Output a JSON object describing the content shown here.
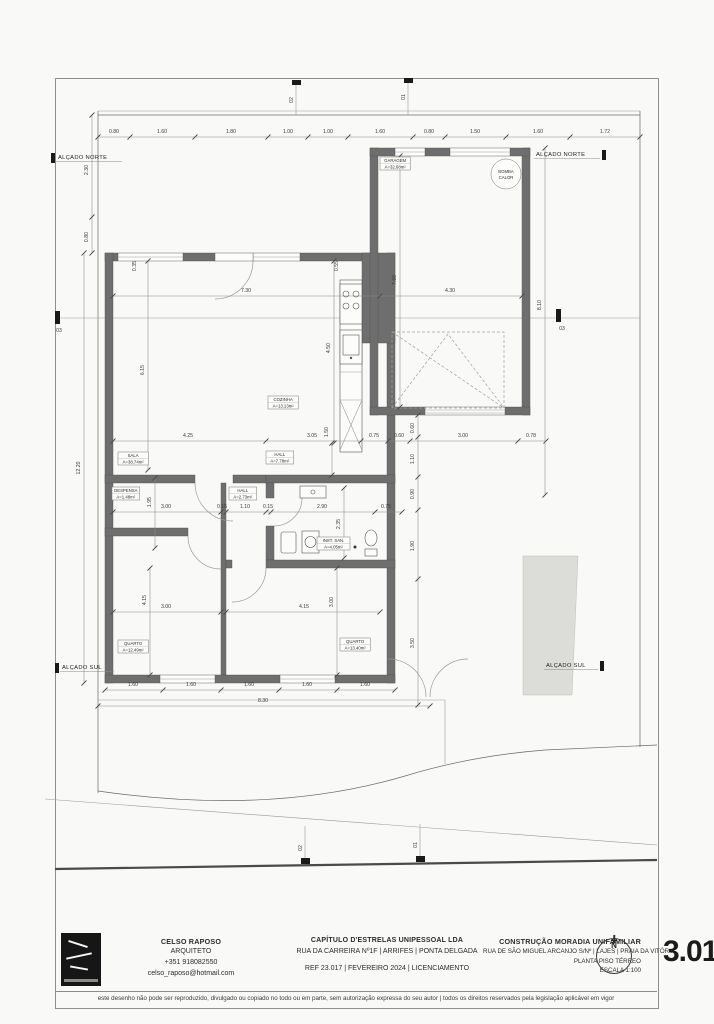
{
  "sheet": {
    "number": "3.01",
    "disclaimer": "este desenho não pode ser reproduzido, divulgado ou copiado no todo ou em parte, sem autorização expressa do seu autor | todos os direitos reservados pela legislação aplicável em vigor"
  },
  "title_block": {
    "architect": {
      "name": "CELSO RAPOSO",
      "role": "ARQUITETO",
      "phone": "+351 918082550",
      "email": "celso_raposo@hotmail.com"
    },
    "office": {
      "name": "CAPÍTULO D'ESTRELAS UNIPESSOAL LDA",
      "address": "RUA DA CARREIRA Nº1F | ARRIFES | PONTA DELGADA",
      "ref": "REF 23.017 | FEVEREIRO 2024 | LICENCIAMENTO"
    },
    "project": {
      "name": "CONSTRUÇÃO MORADIA UNIFAMILIAR",
      "address": "RUA DE SÃO MIGUEL ARCANJO S/Nº | LAJES | PRAIA DA VITÓRIA",
      "drawing": "PLANTA PISO TÉRREO",
      "scale": "ESCALA 1:100"
    },
    "north": "N"
  },
  "plan": {
    "room_labels": [
      {
        "name": "GARAGEM",
        "area": "A=32.68m²",
        "x": 380,
        "y": 157
      },
      {
        "name": "SALA",
        "area": "A=38.74m²",
        "x": 118,
        "y": 452
      },
      {
        "name": "COZINHA",
        "area": "A=13.13m²",
        "x": 268,
        "y": 396
      },
      {
        "name": "HALL",
        "area": "A=7.78m²",
        "x": 266,
        "y": 451
      },
      {
        "name": "HALL",
        "area": "A=2.73m²",
        "x": 229,
        "y": 487
      },
      {
        "name": "DESPENSA",
        "area": "A=1.48m²",
        "x": 112,
        "y": 487
      },
      {
        "name": "INST. SAN.",
        "area": "A=4.05m²",
        "x": 317,
        "y": 537
      },
      {
        "name": "QUARTO",
        "area": "A=12.49m²",
        "x": 118,
        "y": 640
      },
      {
        "name": "QUARTO",
        "area": "A=13.40m²",
        "x": 340,
        "y": 638
      }
    ],
    "equipment_labels": [
      {
        "line1": "BOMBA",
        "line2": "CALOR",
        "x": 506,
        "y": 174
      }
    ],
    "elevation_labels": [
      {
        "text": "ALÇADO NORTE",
        "x": 58,
        "y": 159,
        "w": 64,
        "cap": "left"
      },
      {
        "text": "ALÇADO NORTE",
        "x": 536,
        "y": 156,
        "w": 64,
        "cap": "right"
      },
      {
        "text": "ALÇADO SUL",
        "x": 62,
        "y": 669,
        "w": 52,
        "cap": "left"
      },
      {
        "text": "ALÇADO SUL",
        "x": 546,
        "y": 667,
        "w": 52,
        "cap": "right"
      }
    ],
    "section_markers": [
      {
        "label": "03",
        "x": 59,
        "y": 332
      },
      {
        "label": "03",
        "x": 562,
        "y": 330
      },
      {
        "label": "02",
        "x": 293,
        "y": 100,
        "r": -90
      },
      {
        "label": "01",
        "x": 405,
        "y": 97,
        "r": -90
      },
      {
        "label": "02",
        "x": 302,
        "y": 848,
        "r": -90
      },
      {
        "label": "01",
        "x": 417,
        "y": 845,
        "r": -90
      }
    ],
    "dim_labels": [
      {
        "t": "0.80",
        "x": 114,
        "y": 133
      },
      {
        "t": "1.60",
        "x": 162,
        "y": 133
      },
      {
        "t": "1.80",
        "x": 231,
        "y": 133
      },
      {
        "t": "1.00",
        "x": 288,
        "y": 133
      },
      {
        "t": "1.00",
        "x": 328,
        "y": 133
      },
      {
        "t": "1.60",
        "x": 380,
        "y": 133
      },
      {
        "t": "0.80",
        "x": 429,
        "y": 133
      },
      {
        "t": "1.50",
        "x": 475,
        "y": 133
      },
      {
        "t": "1.60",
        "x": 538,
        "y": 133
      },
      {
        "t": "1.72",
        "x": 605,
        "y": 133
      },
      {
        "t": "2.30",
        "x": 88,
        "y": 170,
        "r": -90
      },
      {
        "t": "0.80",
        "x": 88,
        "y": 237,
        "r": -90
      },
      {
        "t": "12.20",
        "x": 80,
        "y": 468,
        "r": -90
      },
      {
        "t": "7.30",
        "x": 246,
        "y": 292
      },
      {
        "t": "4.30",
        "x": 450,
        "y": 292
      },
      {
        "t": "6.15",
        "x": 144,
        "y": 370,
        "r": -90
      },
      {
        "t": "4.50",
        "x": 330,
        "y": 348,
        "r": -90
      },
      {
        "t": "7.60",
        "x": 396,
        "y": 280,
        "r": -90
      },
      {
        "t": "8.10",
        "x": 541,
        "y": 305,
        "r": -90
      },
      {
        "t": "0.35",
        "x": 136,
        "y": 266,
        "r": -90
      },
      {
        "t": "0.55",
        "x": 338,
        "y": 266,
        "r": -90
      },
      {
        "t": "4.25",
        "x": 188,
        "y": 437
      },
      {
        "t": "3.05",
        "x": 312,
        "y": 437
      },
      {
        "t": "0.75",
        "x": 374,
        "y": 437
      },
      {
        "t": "0.60",
        "x": 399,
        "y": 437
      },
      {
        "t": "3.00",
        "x": 463,
        "y": 437
      },
      {
        "t": "0.78",
        "x": 531,
        "y": 437
      },
      {
        "t": "1.50",
        "x": 328,
        "y": 432,
        "r": -90
      },
      {
        "t": "0.60",
        "x": 414,
        "y": 428,
        "r": -90
      },
      {
        "t": "1.10",
        "x": 414,
        "y": 459,
        "r": -90
      },
      {
        "t": "0.90",
        "x": 414,
        "y": 494,
        "r": -90
      },
      {
        "t": "1.90",
        "x": 414,
        "y": 546,
        "r": -90
      },
      {
        "t": "3.50",
        "x": 414,
        "y": 643,
        "r": -90
      },
      {
        "t": "3.00",
        "x": 166,
        "y": 508
      },
      {
        "t": "0.15",
        "x": 222,
        "y": 508
      },
      {
        "t": "1.10",
        "x": 245,
        "y": 508
      },
      {
        "t": "0.15",
        "x": 268,
        "y": 508
      },
      {
        "t": "2.90",
        "x": 322,
        "y": 508
      },
      {
        "t": "0.75",
        "x": 386,
        "y": 508
      },
      {
        "t": "1.95",
        "x": 151,
        "y": 502,
        "r": -90
      },
      {
        "t": "2.35",
        "x": 340,
        "y": 524,
        "r": -90
      },
      {
        "t": "3.00",
        "x": 166,
        "y": 608
      },
      {
        "t": "4.15",
        "x": 304,
        "y": 608
      },
      {
        "t": "4.15",
        "x": 146,
        "y": 600,
        "r": -90
      },
      {
        "t": "3.00",
        "x": 333,
        "y": 602,
        "r": -90
      },
      {
        "t": "1.60",
        "x": 133,
        "y": 686
      },
      {
        "t": "1.60",
        "x": 191,
        "y": 686
      },
      {
        "t": "1.60",
        "x": 249,
        "y": 686
      },
      {
        "t": "1.60",
        "x": 307,
        "y": 686
      },
      {
        "t": "1.60",
        "x": 365,
        "y": 686
      },
      {
        "t": "8.30",
        "x": 263,
        "y": 702
      }
    ]
  }
}
